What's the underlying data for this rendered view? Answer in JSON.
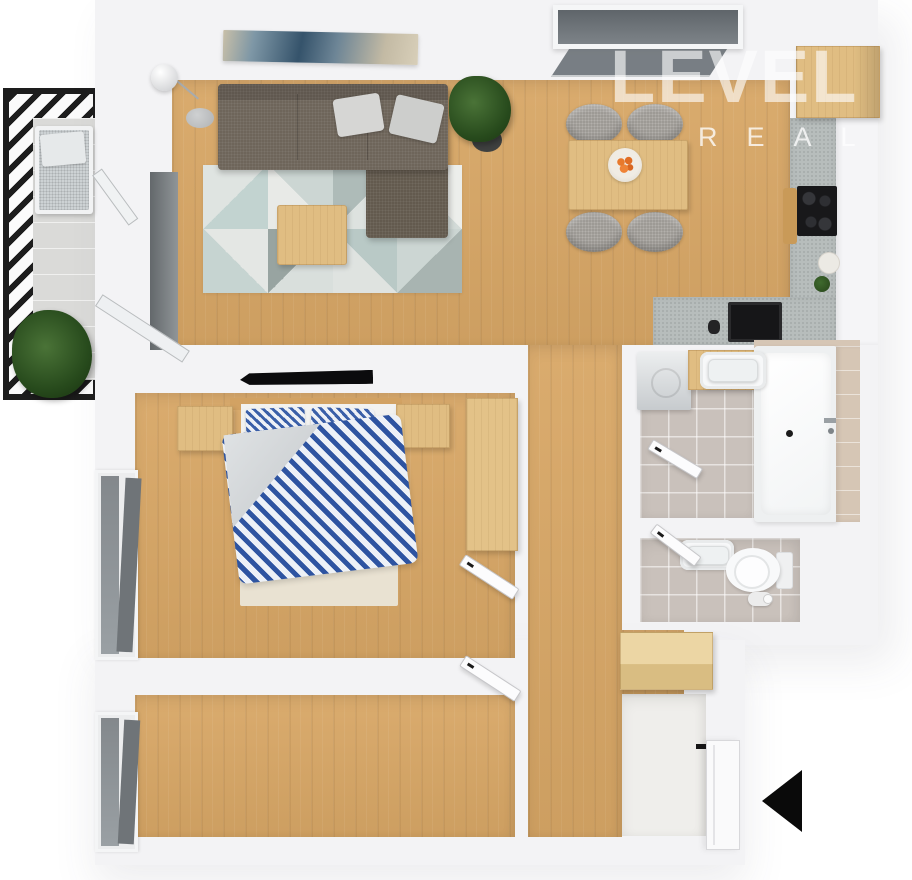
{
  "watermark": {
    "title": "LEVEL",
    "subtitle": "REAL"
  },
  "icons": {
    "entrance_arrow": "arrow-left-filled-triangle"
  },
  "colors": {
    "wall": "#f3f3f5",
    "wood_floor": "#d8a766",
    "wood_furniture": "#e0bd82",
    "sofa_gray_brown": "#6e655a",
    "rug_pale_blue": "#c2d3d0",
    "duvet_blue": "#2e54a1",
    "counter_terrazzo": "#b7bdbc",
    "bath_tile_floor": "#c9c1bb",
    "accent_tile_beige": "#d6c6b5",
    "railing_black": "#1d1d1d",
    "appliance_black": "#18181a",
    "arrow_black": "#0a0a0a",
    "watermark_white": "#ffffff",
    "plant_green": "#2f5423",
    "orange_fruit": "#e8792c"
  },
  "apartment": {
    "view": "3d-top-down-floor-plan",
    "rooms": [
      {
        "name": "balcony",
        "objects": [
          "black slatted railing",
          "lounge daybed with gray cushion",
          "large potted plant"
        ]
      },
      {
        "name": "living-room",
        "objects": [
          "corner sofa with two cushions",
          "geometric triangle rug",
          "wooden coffee table",
          "floor lamp",
          "abstract wall art",
          "potted plant",
          "open balcony doors"
        ]
      },
      {
        "name": "kitchen-dining",
        "objects": [
          "wooden dining table",
          "four gray chairs",
          "bowl of oranges",
          "L-shaped terrazzo counter",
          "black cooktop",
          "black sink",
          "cutting board",
          "tall wooden cabinet",
          "tilted top window"
        ]
      },
      {
        "name": "bedroom",
        "objects": [
          "double bed with blue striped duvet",
          "two striped pillows",
          "left nightstand",
          "right nightstand",
          "wardrobe",
          "wall-mounted TV",
          "side window",
          "door"
        ]
      },
      {
        "name": "bathroom",
        "objects": [
          "washing machine",
          "washbasin on wooden counter",
          "bathtub",
          "beige tiled accent wall",
          "door"
        ]
      },
      {
        "name": "wc",
        "objects": [
          "washbasin",
          "toilet",
          "toilet paper roll",
          "door"
        ]
      },
      {
        "name": "second-room",
        "objects": [
          "side window",
          "door"
        ]
      },
      {
        "name": "hallway-entrance",
        "objects": [
          "wooden bench",
          "entrance door",
          "black entrance arrow"
        ]
      }
    ]
  }
}
